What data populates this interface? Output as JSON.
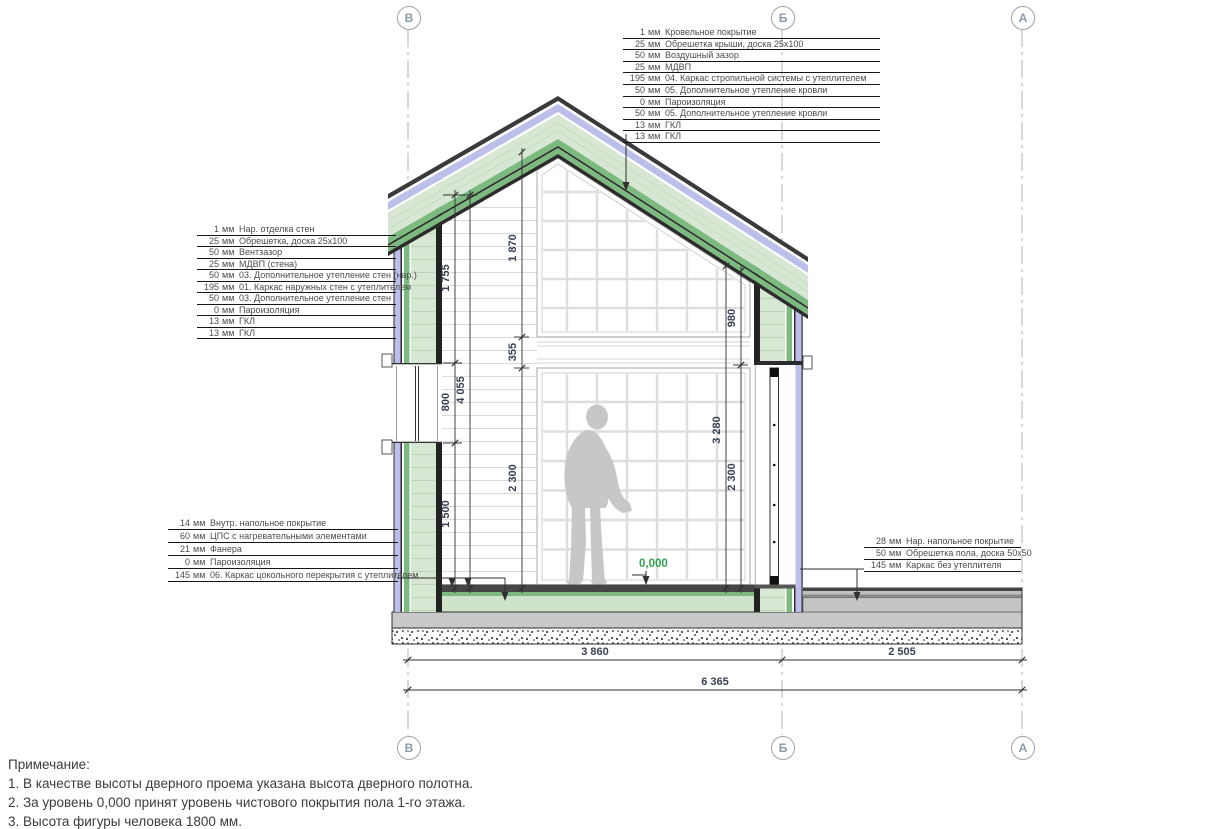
{
  "axes": {
    "labels": [
      "В",
      "Б",
      "А"
    ]
  },
  "callouts": {
    "roof": {
      "rows": [
        {
          "value": "1",
          "unit": "мм",
          "label": "Кровельное покрытие"
        },
        {
          "value": "25",
          "unit": "мм",
          "label": "Обрешетка крыши, доска 25x100"
        },
        {
          "value": "50",
          "unit": "мм",
          "label": "Воздушный зазор"
        },
        {
          "value": "25",
          "unit": "мм",
          "label": "МДВП"
        },
        {
          "value": "195",
          "unit": "мм",
          "label": "04. Каркас стропильной системы с утеплителем"
        },
        {
          "value": "50",
          "unit": "мм",
          "label": "05. Дополнительное утепление кровли"
        },
        {
          "value": "0",
          "unit": "мм",
          "label": "Пароизоляция"
        },
        {
          "value": "50",
          "unit": "мм",
          "label": "05. Дополнительное утепление кровли"
        },
        {
          "value": "13",
          "unit": "мм",
          "label": "ГКЛ"
        },
        {
          "value": "13",
          "unit": "мм",
          "label": "ГКЛ"
        }
      ]
    },
    "wall": {
      "rows": [
        {
          "value": "1",
          "unit": "мм",
          "label": "Нар. отделка стен"
        },
        {
          "value": "25",
          "unit": "мм",
          "label": "Обрешетка, доска 25x100"
        },
        {
          "value": "50",
          "unit": "мм",
          "label": "Вентзазор"
        },
        {
          "value": "25",
          "unit": "мм",
          "label": "МДВП (стена)"
        },
        {
          "value": "50",
          "unit": "мм",
          "label": "03. Дополнительное утепление стен (нар.)"
        },
        {
          "value": "195",
          "unit": "мм",
          "label": "01. Каркас наружных стен с утеплителем"
        },
        {
          "value": "50",
          "unit": "мм",
          "label": "03. Дополнительное утепление стен"
        },
        {
          "value": "0",
          "unit": "мм",
          "label": "Пароизоляция"
        },
        {
          "value": "13",
          "unit": "мм",
          "label": "ГКЛ"
        },
        {
          "value": "13",
          "unit": "мм",
          "label": "ГКЛ"
        }
      ]
    },
    "floor_interior": {
      "rows": [
        {
          "value": "14",
          "unit": "мм",
          "label": "Внутр. напольное покрытие"
        },
        {
          "value": "60",
          "unit": "мм",
          "label": "ЦПС с нагревательными элементами"
        },
        {
          "value": "21",
          "unit": "мм",
          "label": "Фанера"
        },
        {
          "value": "0",
          "unit": "мм",
          "label": "Пароизоляция"
        },
        {
          "value": "145",
          "unit": "мм",
          "label": "06. Каркас цокольного перекрытия с утеплителем"
        }
      ]
    },
    "floor_terrace": {
      "rows": [
        {
          "value": "28",
          "unit": "мм",
          "label": "Нар. напольное покрытие"
        },
        {
          "value": "50",
          "unit": "мм",
          "label": "Обрешетка пола, доска 50x50"
        },
        {
          "value": "145",
          "unit": "мм",
          "label": "Каркас без утеплителя"
        }
      ]
    }
  },
  "dims": {
    "window_top": "1 755",
    "window_height": "800",
    "window_sill": "1 500",
    "wall_total": "4 055",
    "gable_glazing": "1 870",
    "band": "355",
    "room_height": "2 300",
    "right_total": "3 280",
    "gable_right": "980",
    "door_height": "2 300",
    "span_house": "3 860",
    "span_terrace": "2 505",
    "span_total": "6 365",
    "level_zero": "0,000"
  },
  "notes": {
    "title": "Примечание:",
    "items": [
      "1. В качестве высоты дверного проема указана высота дверного полотна.",
      "2. За уровень 0,000 принят уровень чистового покрытия пола 1-го этажа.",
      "3. Высота фигуры человека 1800 мм."
    ]
  },
  "colors": {
    "accent_green": "#7cba80",
    "pale_green": "#d7e7d3",
    "lavender": "#bcbfea",
    "level_green": "#2ea44f",
    "dim_text": "#3a4252"
  }
}
